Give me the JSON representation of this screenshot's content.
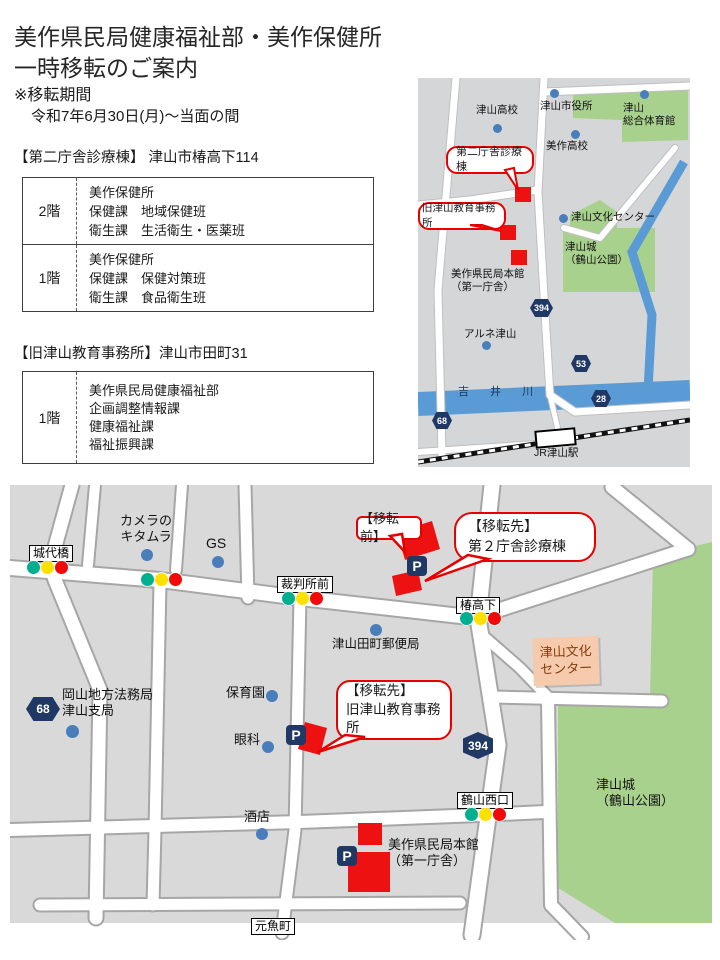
{
  "header": {
    "title_line1": "美作県民局健康福祉部・美作保健所",
    "title_line2": "一時移転のご案内",
    "period_label": "※移転期間",
    "period_value": "令和7年6月30日(月)～当面の間"
  },
  "clinic_building": {
    "heading": "【第二庁舎診療棟】 津山市椿高下114",
    "rows": [
      {
        "floor": "2階",
        "depts": "美作保健所\n保健課　地域保健班\n衛生課　生活衛生・医薬班"
      },
      {
        "floor": "1階",
        "depts": "美作保健所\n保健課　保健対策班\n衛生課　食品衛生班"
      }
    ]
  },
  "old_office": {
    "heading": "【旧津山教育事務所】津山市田町31",
    "rows": [
      {
        "floor": "1階",
        "depts": "美作県民局健康福祉部\n企画調整情報課\n健康福祉課\n福祉振興課"
      }
    ]
  },
  "overview_map": {
    "tsuyama_highschool": "津山高校",
    "city_hall": "津山市役所",
    "gym": "津山\n総合体育館",
    "mimasaka_highschool": "美作高校",
    "clinic_callout": "第二庁舎診療棟",
    "old_office_callout": "旧津山教育事務所",
    "culture_center": "津山文化センター",
    "castle": "津山城\n（鶴山公園）",
    "honkan": "美作県民局本館\n（第一庁舎）",
    "arune": "アルネ津山",
    "river": "吉 井 川",
    "station": "JR津山駅",
    "route_394": "394",
    "route_53": "53",
    "route_28": "28",
    "route_68": "68"
  },
  "detail_map": {
    "kitamura": "カメラの\nキタムラ",
    "gs": "GS",
    "joudaibashi": "城代橋",
    "saibansho_mae": "裁判所前",
    "tsubakikouge": "椿高下",
    "kakuzan_nishiguchi": "鶴山西口",
    "post_office": "津山田町郵便局",
    "houmukyoku": "岡山地方法務局\n津山支局",
    "hoikuen": "保育園",
    "ganka": "眼科",
    "saketen": "酒店",
    "culture_center": "津山文化\nセンター",
    "castle": "津山城\n（鶴山公園）",
    "honkan": "美作県民局本館\n（第一庁舎）",
    "motouo_machi": "元魚町",
    "before_callout": "【移転前】",
    "dest_clinic_callout": "【移転先】\n第２庁舎診療棟",
    "dest_old_callout": "【移転先】\n旧津山教育事務所",
    "route_68": "68",
    "route_394": "394",
    "parking": "P"
  },
  "colors": {
    "map_gray": "#d9d9da",
    "road_white": "#ffffff",
    "park_green": "#a9d18e",
    "river_blue": "#5b9bd5",
    "poi_dot_blue": "#4a7ebb",
    "highlight_red": "#ee1111",
    "callout_border_red": "#e60000",
    "badge_navy": "#1f3864",
    "culture_orange": "#f6caac",
    "signal_green": "#00af8f",
    "signal_yellow": "#ffe100",
    "signal_red": "#f00a0a"
  }
}
